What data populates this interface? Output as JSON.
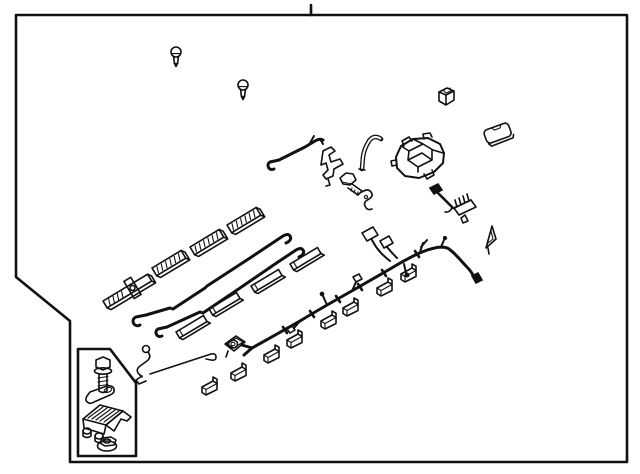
{
  "figure": {
    "kind": "exploded-parts-line-diagram",
    "subject": "wiring harness with clips, brackets and fasteners",
    "text_labels": []
  },
  "diagram": {
    "page_background": "#ffffff",
    "panel_fill": "#f7f7f7",
    "line_color": "#111111",
    "border": {
      "notched_corner": "bottom-left",
      "top_tick_x": 311
    },
    "parts": [
      {
        "id": "push-pin-clip-1",
        "name": "push-pin clip"
      },
      {
        "id": "push-pin-clip-2",
        "name": "push-pin clip"
      },
      {
        "id": "bracket-clip",
        "name": "small bracket clip"
      },
      {
        "id": "cover-pad",
        "name": "rounded cover pad"
      },
      {
        "id": "bent-tube",
        "name": "curved grommet tube"
      },
      {
        "id": "junction-connector-assembly",
        "name": "junction connector assembly"
      },
      {
        "id": "hook-rod",
        "name": "bent hook rod"
      },
      {
        "id": "z-bracket",
        "name": "z-shaped mounting bracket"
      },
      {
        "id": "hex-bolt",
        "name": "hex flange bolt"
      },
      {
        "id": "hose-clamp",
        "name": "small clamp"
      },
      {
        "id": "pigtail-sub-harness",
        "name": "pigtail sub-harness with connectors"
      },
      {
        "id": "pennant-clip",
        "name": "triangular pennant clip"
      },
      {
        "id": "guide-rail",
        "name": "ribbed guide rail with crossbar"
      },
      {
        "id": "ribbed-rail-1",
        "name": "ribbed rail pad"
      },
      {
        "id": "ribbed-rail-2",
        "name": "ribbed rail pad"
      },
      {
        "id": "ribbed-rail-3",
        "name": "ribbed rail pad"
      },
      {
        "id": "long-rod-1",
        "name": "long bent wire rod"
      },
      {
        "id": "long-rod-2",
        "name": "long bent wire rod"
      },
      {
        "id": "sleeve-1",
        "name": "protector sleeve"
      },
      {
        "id": "sleeve-2",
        "name": "protector sleeve"
      },
      {
        "id": "sleeve-3",
        "name": "protector sleeve"
      },
      {
        "id": "sleeve-4",
        "name": "protector sleeve"
      },
      {
        "id": "wire-clamp",
        "name": "bent wire clamp with eyelet"
      },
      {
        "id": "thin-hook-rod",
        "name": "thin rod with hook end"
      },
      {
        "id": "stud-grommet",
        "name": "square grommet with stud"
      },
      {
        "id": "flag-clip",
        "name": "flag clip",
        "count": 8
      },
      {
        "id": "main-wiring-harness",
        "name": "main wiring harness with branch connectors"
      }
    ],
    "hardware_inset": {
      "items": [
        {
          "id": "inset-flange-bolt",
          "name": "flange bolt"
        },
        {
          "id": "inset-strap-clip",
          "name": "retainer strap"
        },
        {
          "id": "inset-mount-module",
          "name": "mounting bracket module"
        },
        {
          "id": "inset-flange-nut",
          "name": "flange nut"
        }
      ]
    }
  }
}
